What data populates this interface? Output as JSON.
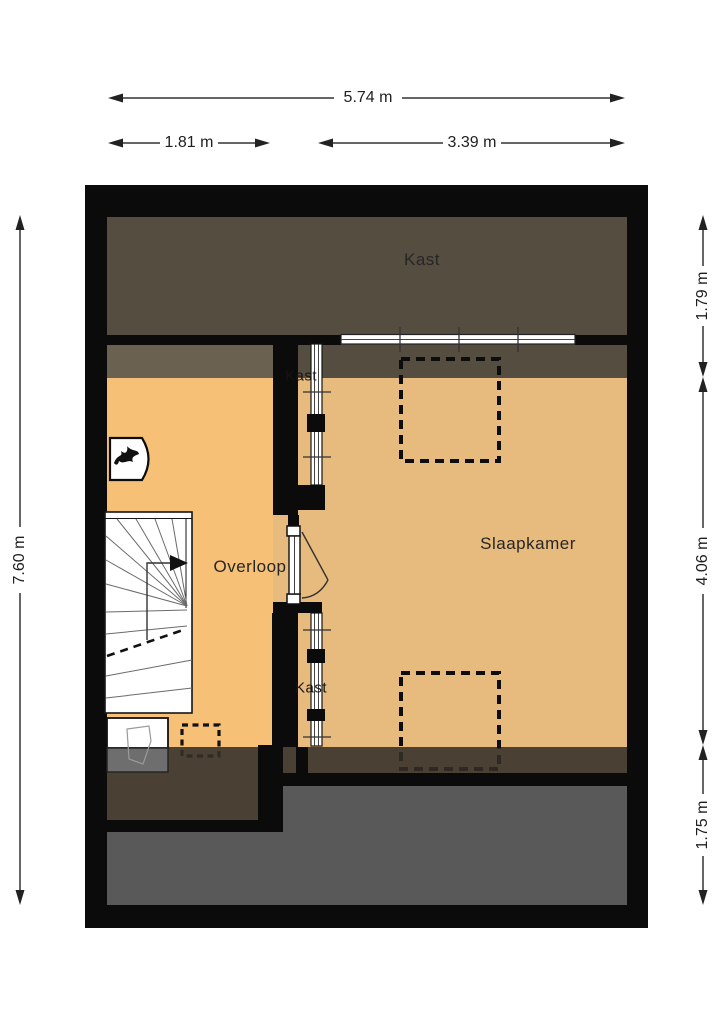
{
  "rooms": {
    "kast_top": "Kast",
    "kast_upper": "Kast",
    "slaapkamer": "Slaapkamer",
    "overloop": "Overloop",
    "kast_lower": "Kast"
  },
  "dimensions": {
    "top_total": "5.74 m",
    "top_left": "1.81 m",
    "top_right": "3.39 m",
    "left_total": "7.60 m",
    "right_top": "1.79 m",
    "right_middle": "4.06 m",
    "right_bottom": "1.75 m"
  },
  "icons": {
    "boiler": "flame-symbol",
    "stair_direction": "arrow-right"
  },
  "colors": {
    "wall": "#0b0b0b",
    "floor_overloop": "#F6C076",
    "floor_slaapkamer": "#E7BA7E",
    "zone_top_dark": "#554D40",
    "zone_olive": "#6B6150",
    "zone_bottom_brown": "#4A4134",
    "zone_gray": "#595959",
    "zone_gray_light": "#6e6e6e",
    "dim_line": "#333333",
    "label_dark": "#262626"
  }
}
